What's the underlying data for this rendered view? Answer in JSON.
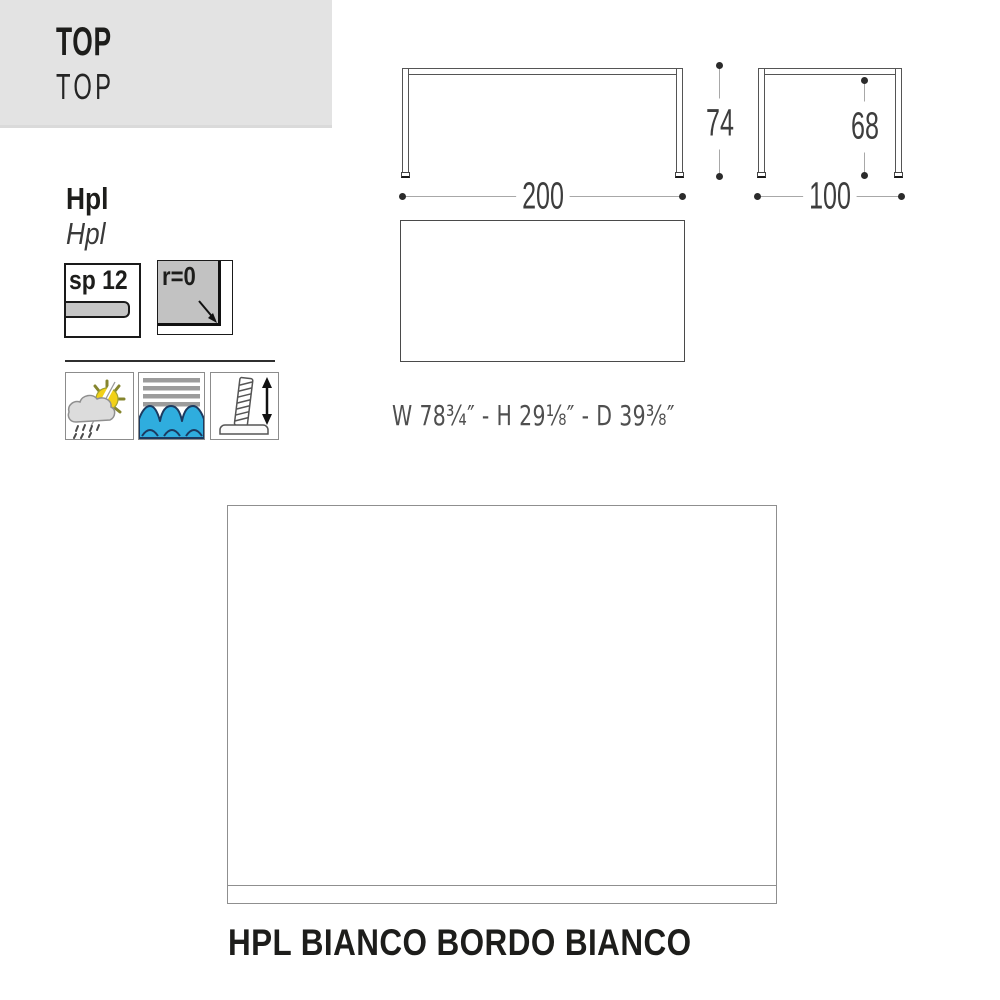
{
  "header": {
    "title": "TOP",
    "subtitle": "TOP",
    "bg_color": "#e3e3e3"
  },
  "material": {
    "name": "Hpl",
    "name_alt": "Hpl"
  },
  "badges": {
    "thickness": "sp 12",
    "corner_radius": "r=0"
  },
  "features": [
    {
      "icon": "sun-rain-weatherproof-icon"
    },
    {
      "icon": "water-waves-icon"
    },
    {
      "icon": "adjustable-foot-icon"
    }
  ],
  "dimensions": {
    "front_width": "200",
    "front_height": "74",
    "side_depth": "100",
    "side_inner_height": "68",
    "imperial": "W 78³⁄₄″ - H 29¹⁄₈″  - D 39³⁄₈″"
  },
  "finish": {
    "caption": "HPL BIANCO BORDO BIANCO",
    "swatch_color": "#ffffff"
  },
  "colors": {
    "header_bg": "#e3e3e3",
    "accent_blue": "#2fadde",
    "wave_outline": "#1c3a60",
    "sun_yellow": "#f2d117",
    "stripe_gray": "#9c9c9c",
    "badge_fill": "#c5c5c5",
    "outline_dark": "#555555",
    "dim_line_gray": "#a8a8a8"
  }
}
